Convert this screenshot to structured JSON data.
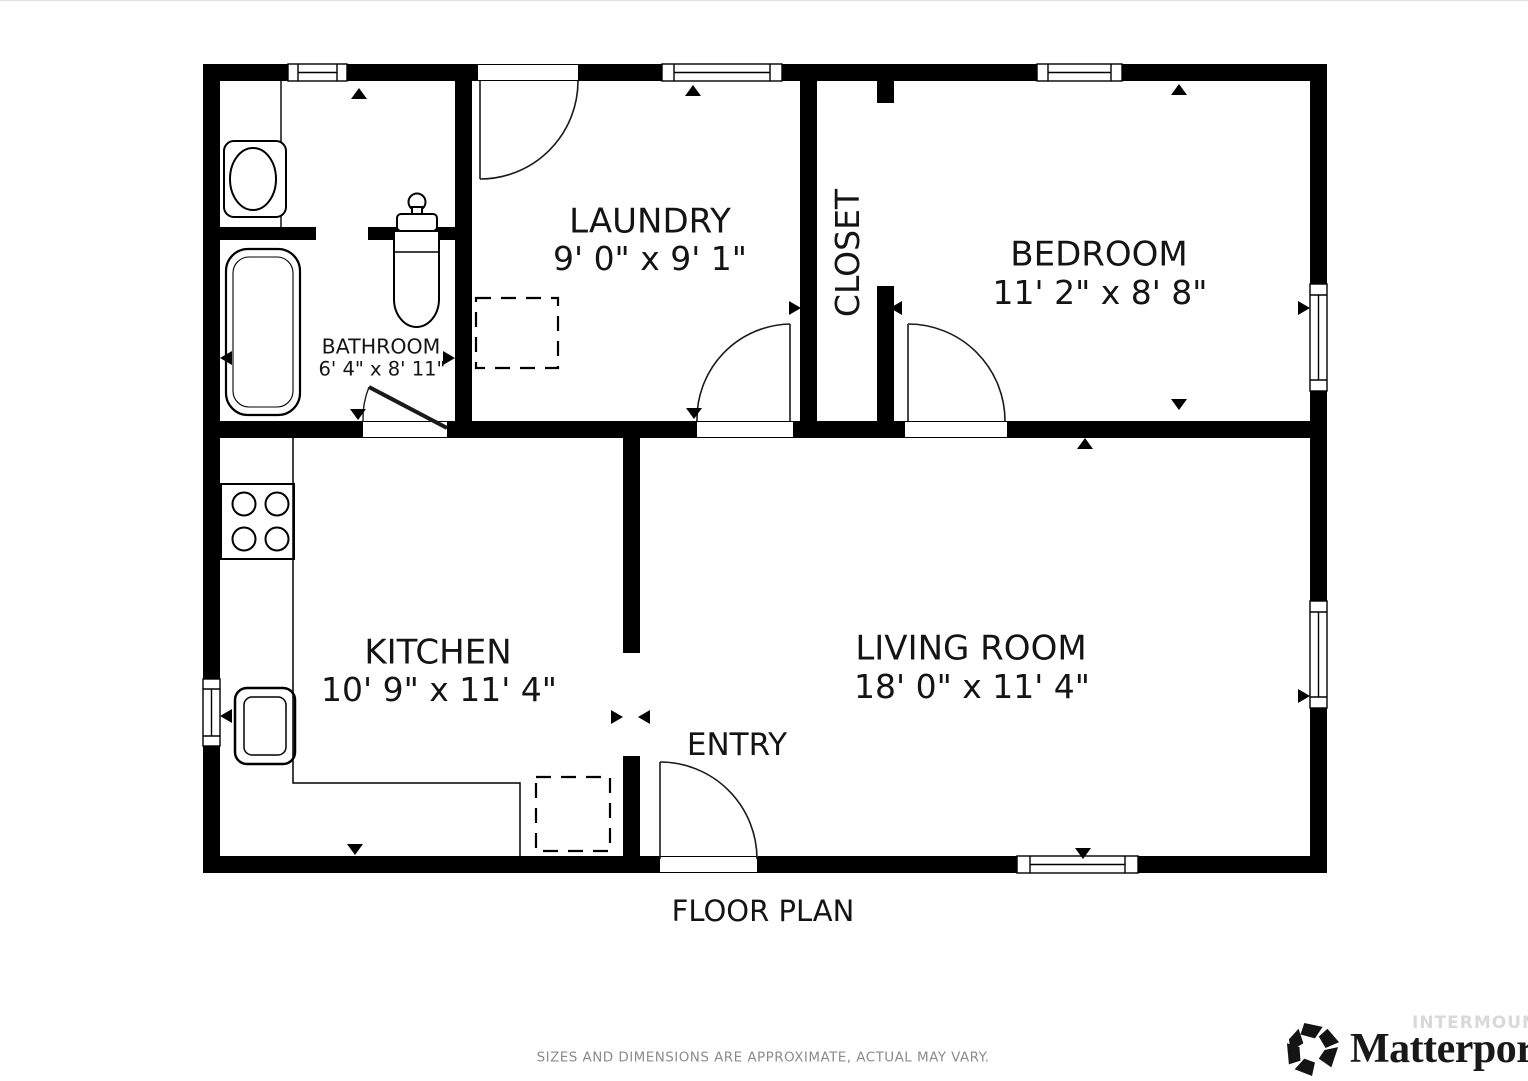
{
  "floor_plan": {
    "title": "FLOOR PLAN",
    "disclaimer": "SIZES AND DIMENSIONS ARE APPROXIMATE, ACTUAL MAY VARY.",
    "rooms": {
      "laundry": {
        "name": "LAUNDRY",
        "dims": "9' 0\" x 9' 1\""
      },
      "bathroom": {
        "name": "BATHROOM",
        "dims": "6' 4\" x 8' 11\""
      },
      "closet": {
        "name": "CLOSET",
        "dims": ""
      },
      "bedroom": {
        "name": "BEDROOM",
        "dims": "11' 2\" x 8' 8\""
      },
      "kitchen": {
        "name": "KITCHEN",
        "dims": "10' 9\" x 11' 4\""
      },
      "living_room": {
        "name": "LIVING ROOM",
        "dims": "18' 0\" x 11' 4\""
      },
      "entry": {
        "name": "ENTRY",
        "dims": ""
      }
    },
    "fixtures": [
      "bathtub-icon",
      "toilet-icon",
      "bathroom-sink-icon",
      "stove-icon",
      "kitchen-sink-icon",
      "appliance-dashed-icon"
    ]
  },
  "branding": {
    "logo_text": "Matterport",
    "registered_mark": "®",
    "watermark": "INTERMOUNTAIN"
  },
  "colors": {
    "walls": "#000000",
    "background": "#ffffff",
    "label_text": "#141414",
    "disclaimer_text": "#8c8c8c",
    "watermark_text": "#d9d9d9"
  }
}
